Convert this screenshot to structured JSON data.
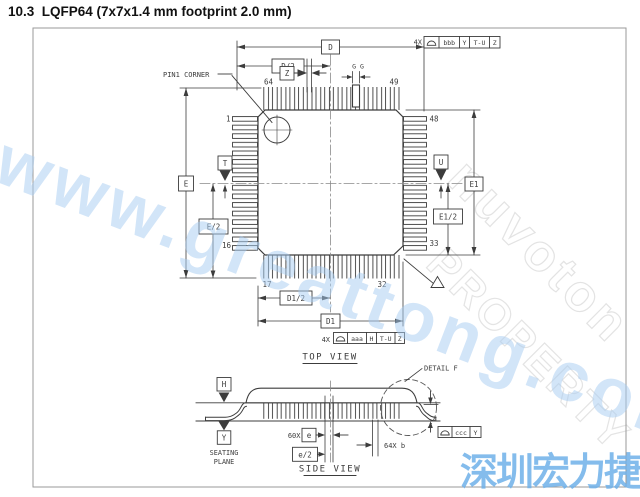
{
  "title": "10.3  LQFP64 (7x7x1.4 mm footprint 2.0 mm)",
  "top_view": {
    "view_label": "TOP VIEW",
    "pin1_corner": "PIN1 CORNER",
    "pin_numbers": {
      "p1": "1",
      "p16": "16",
      "p17": "17",
      "p32": "32",
      "p33": "33",
      "p48": "48",
      "p49": "49",
      "p64": "64"
    },
    "dim_d": "D",
    "dim_d_half": "D/2",
    "dim_z": "Z",
    "dim_gg": "G G",
    "dim_e": "E",
    "dim_e_half": "E/2",
    "dim_e1": "E1",
    "dim_e1_half": "E1/2",
    "dim_d1": "D1",
    "dim_d1_half": "D1/2",
    "datum_t": "T",
    "datum_u": "U",
    "fcf_top": {
      "qty": "4X",
      "tol": "bbb",
      "ref1": "Y",
      "ref2": "T-U",
      "ref3": "Z"
    },
    "fcf_bottom": {
      "qty": "4X",
      "tol": "aaa",
      "ref1": "H",
      "ref2": "T-U",
      "ref3": "Z"
    }
  },
  "side_view": {
    "view_label": "SIDE VIEW",
    "detail_f": "DETAIL F",
    "datum_h": "H",
    "datum_y": "Y",
    "seating_line1": "SEATING",
    "seating_line2": "PLANE",
    "pitch_qty": "60X",
    "dim_pitch": "e",
    "dim_pitch_half": "e/2",
    "lead_width": "64X b",
    "fcf_side": {
      "tol": "ccc",
      "ref1": "Y"
    }
  },
  "watermarks": {
    "diagonal_url": "www.greattong.com",
    "outline_line1": "nuvoton",
    "outline_line2": "PROPERTY",
    "corner_cjk": "深圳宏力捷"
  },
  "colors": {
    "line": "#3c3c3c",
    "centerline": "#8a8a8a",
    "watermark_blue": "#a6cbf2",
    "watermark_cjk": "#6eb0e9",
    "outline_gray": "#e3e3e3"
  }
}
